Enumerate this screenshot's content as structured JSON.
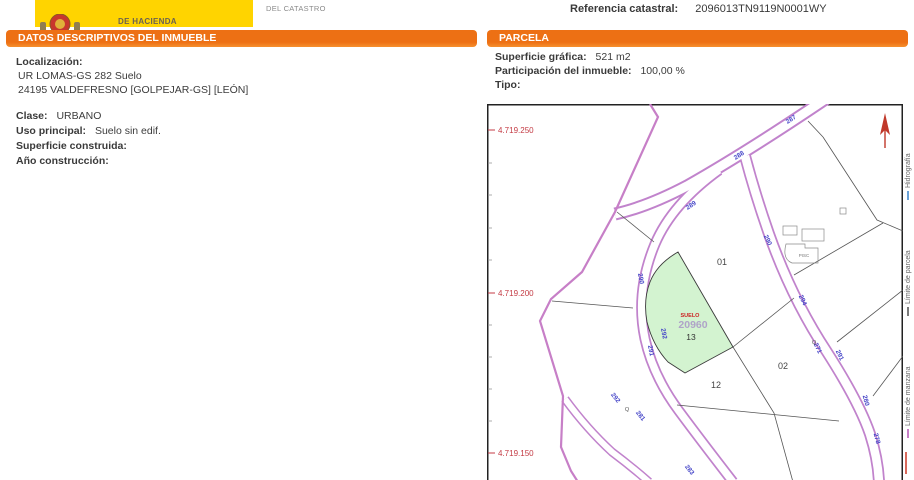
{
  "header": {
    "ministry_text": "DE HACIENDA",
    "catastro_text": "DEL CATASTRO",
    "reference_label": "Referencia catastral:",
    "reference_value": "2096013TN9119N0001WY"
  },
  "sections": {
    "left_title": "DATOS DESCRIPTIVOS DEL INMUEBLE",
    "right_title": "PARCELA"
  },
  "property": {
    "localizacion_label": "Localización:",
    "address_line1": "UR LOMAS-GS 282 Suelo",
    "address_line2": "24195 VALDEFRESNO [GOLPEJAR-GS] [LEÓN]",
    "clase_label": "Clase:",
    "clase_value": "URBANO",
    "uso_label": "Uso principal:",
    "uso_value": "Suelo sin edif.",
    "superficie_label": "Superficie construida:",
    "superficie_value": "",
    "anio_label": "Año construcción:",
    "anio_value": ""
  },
  "parcela": {
    "superficie_grafica_label": "Superficie gráfica:",
    "superficie_grafica_value": "521 m2",
    "participacion_label": "Participación del inmueble:",
    "participacion_value": "100,00 %",
    "tipo_label": "Tipo:",
    "tipo_value": ""
  },
  "map": {
    "coordinate_labels": [
      "4.719.250",
      "4.719.200",
      "4.719.150"
    ],
    "highlight_parcel": {
      "suelo_label": "SUELO",
      "number": "20960",
      "sub": "13"
    },
    "parcel_labels": [
      "01",
      "02",
      "12"
    ],
    "road_labels": [
      "287",
      "288",
      "289",
      "290",
      "294",
      "271",
      "291",
      "280",
      "278",
      "290",
      "292",
      "291",
      "292",
      "281",
      "283"
    ],
    "symbol_q": "Q",
    "building_label": "PISC",
    "legend": [
      {
        "label": "Hidrografía"
      },
      {
        "label": "Límite de parcela"
      },
      {
        "label": "Límite de manzana"
      }
    ]
  },
  "colors": {
    "accent_orange": "#ED7014",
    "banner_yellow": "#FFD400",
    "road_purple": "#C183CC",
    "boundary_purple": "#C77FC7",
    "parcel_green": "#D3F3D0",
    "coordinate_red": "#C43B44",
    "road_label_blue": "#4646C8"
  }
}
